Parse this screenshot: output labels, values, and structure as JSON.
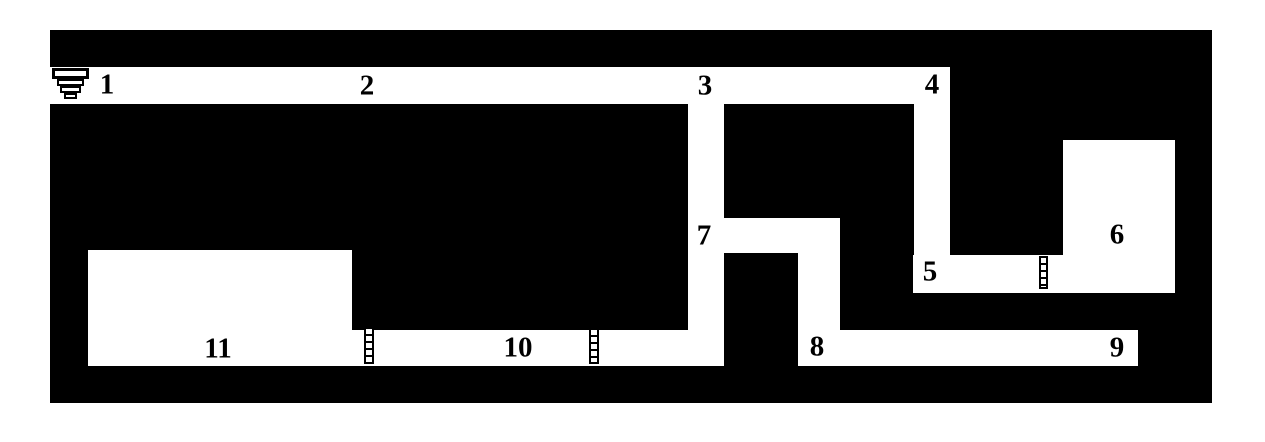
{
  "colors": {
    "background": "#ffffff",
    "rock": "#000000",
    "passage": "#ffffff",
    "label": "#000000"
  },
  "map": {
    "outline": {
      "x": 50,
      "y": 30,
      "w": 1162,
      "h": 373
    },
    "passages": [
      {
        "name": "corridor-top-1-to-4",
        "x": 50,
        "y": 67,
        "w": 900,
        "h": 37
      },
      {
        "name": "shaft-below-3",
        "x": 688,
        "y": 104,
        "w": 36,
        "h": 262
      },
      {
        "name": "branch-passage-7",
        "x": 723,
        "y": 218,
        "w": 117,
        "h": 35
      },
      {
        "name": "shaft-7-to-8",
        "x": 798,
        "y": 253,
        "w": 42,
        "h": 80
      },
      {
        "name": "corridor-8-to-9",
        "x": 798,
        "y": 330,
        "w": 340,
        "h": 36
      },
      {
        "name": "shaft-below-4",
        "x": 914,
        "y": 104,
        "w": 36,
        "h": 154
      },
      {
        "name": "corridor-5-to-6",
        "x": 913,
        "y": 255,
        "w": 150,
        "h": 38
      },
      {
        "name": "room-6",
        "x": 1063,
        "y": 140,
        "w": 112,
        "h": 153
      },
      {
        "name": "room-11",
        "x": 88,
        "y": 250,
        "w": 264,
        "h": 116
      },
      {
        "name": "corridor-11-to-10",
        "x": 352,
        "y": 330,
        "w": 372,
        "h": 36
      }
    ],
    "labels": [
      {
        "text": "1",
        "x": 107,
        "y": 85
      },
      {
        "text": "2",
        "x": 367,
        "y": 86
      },
      {
        "text": "3",
        "x": 705,
        "y": 86
      },
      {
        "text": "4",
        "x": 932,
        "y": 85
      },
      {
        "text": "5",
        "x": 930,
        "y": 272
      },
      {
        "text": "6",
        "x": 1117,
        "y": 235
      },
      {
        "text": "7",
        "x": 704,
        "y": 236
      },
      {
        "text": "8",
        "x": 817,
        "y": 347
      },
      {
        "text": "9",
        "x": 1117,
        "y": 348
      },
      {
        "text": "10",
        "x": 518,
        "y": 348
      },
      {
        "text": "11",
        "x": 218,
        "y": 349
      }
    ],
    "icons": {
      "entrance": {
        "name": "entrance-steps-icon",
        "x": 52,
        "y": 68,
        "tiers": [
          {
            "w": 37,
            "h": 11,
            "b": 3
          },
          {
            "w": 27,
            "h": 7,
            "b": 2
          },
          {
            "w": 21,
            "h": 7,
            "b": 2
          },
          {
            "w": 13,
            "h": 6,
            "b": 2
          }
        ]
      },
      "ladders": [
        {
          "name": "ladder-icon",
          "x": 364,
          "y": 327,
          "w": 10,
          "h": 37
        },
        {
          "name": "ladder-icon",
          "x": 589,
          "y": 328,
          "w": 10,
          "h": 36
        },
        {
          "name": "ladder-icon",
          "x": 1039,
          "y": 256,
          "w": 9,
          "h": 33
        }
      ]
    }
  }
}
